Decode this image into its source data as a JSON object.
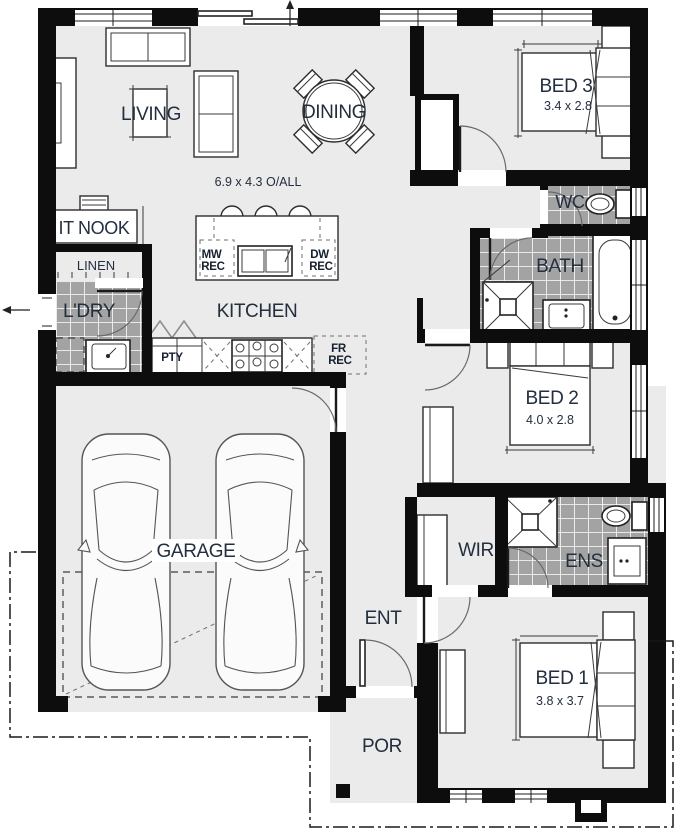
{
  "plan": {
    "overall_dim": "6.9 x 4.3 O/ALL",
    "rooms": {
      "living": {
        "label": "LIVING"
      },
      "dining": {
        "label": "DINING"
      },
      "it_nook": {
        "label": "IT NOOK"
      },
      "linen": {
        "label": "LINEN"
      },
      "ldry": {
        "label": "L'DRY"
      },
      "kitchen": {
        "label": "KITCHEN"
      },
      "pty": {
        "label": "PTY"
      },
      "garage": {
        "label": "GARAGE"
      },
      "bed3": {
        "label": "BED 3",
        "dim": "3.4 x 2.8"
      },
      "wc": {
        "label": "WC"
      },
      "bath": {
        "label": "BATH"
      },
      "bed2": {
        "label": "BED 2",
        "dim": "4.0 x 2.8"
      },
      "wir": {
        "label": "WIR"
      },
      "ens": {
        "label": "ENS"
      },
      "bed1": {
        "label": "BED 1",
        "dim": "3.8 x 3.7"
      },
      "ent": {
        "label": "ENT"
      },
      "por": {
        "label": "POR"
      }
    },
    "appliances": {
      "mw_rec": {
        "l1": "MW",
        "l2": "REC"
      },
      "dw_rec": {
        "l1": "DW",
        "l2": "REC"
      },
      "fr_rec": {
        "l1": "FR",
        "l2": "REC"
      }
    },
    "colors": {
      "wall": "#0d0d0d",
      "floor": "#ebebeb",
      "tile": "#a3a3a3",
      "tile_grout": "#ffffff",
      "label_text": "#232e3e"
    }
  }
}
